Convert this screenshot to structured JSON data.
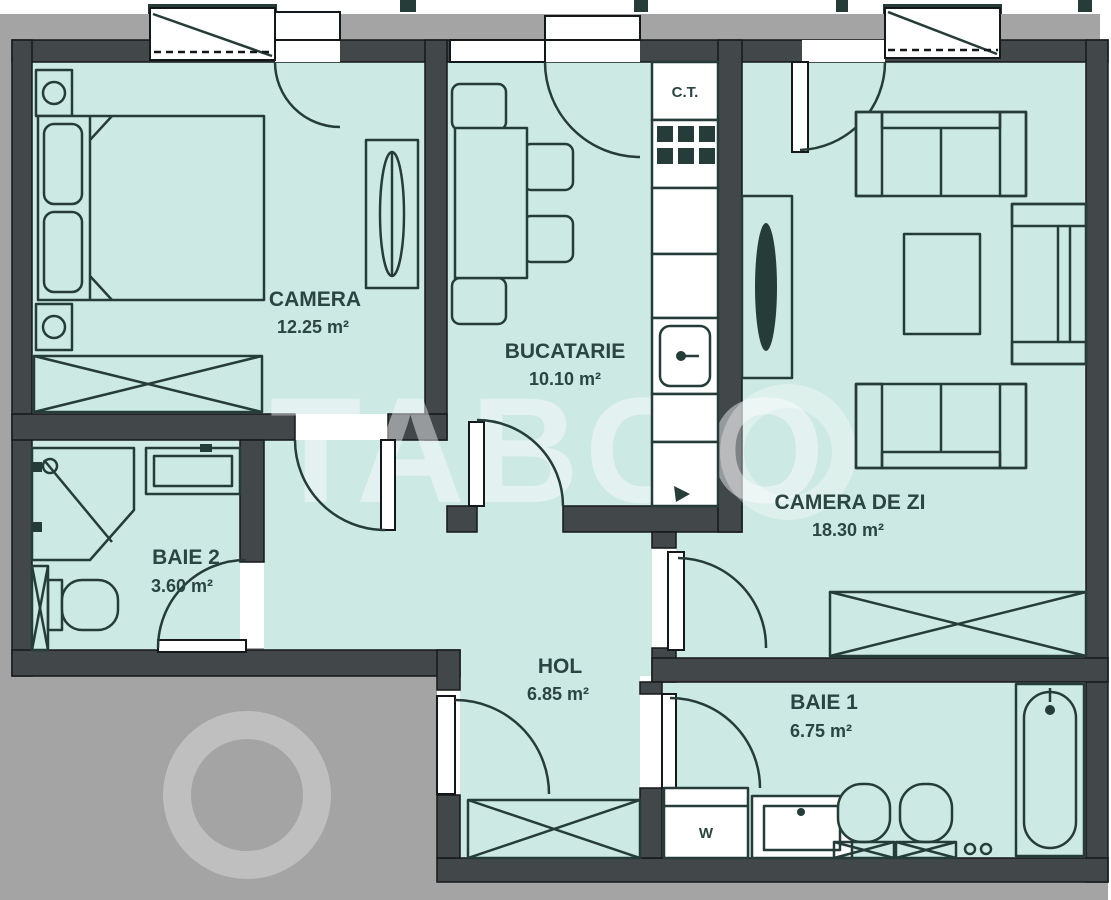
{
  "watermark": {
    "text": "TABOO"
  },
  "colors": {
    "floor": "#cde9e4",
    "wall": "#42474a",
    "outside": "#a3a4a3",
    "line": "#253c39",
    "label": "#2b4542"
  },
  "rooms": {
    "camera": {
      "name": "CAMERA",
      "area": "12.25 m²"
    },
    "bucatarie": {
      "name": "BUCATARIE",
      "area": "10.10 m²"
    },
    "camera_de_zi": {
      "name": "CAMERA DE ZI",
      "area": "18.30 m²"
    },
    "baie2": {
      "name": "BAIE 2",
      "area": "3.60 m²"
    },
    "hol": {
      "name": "HOL",
      "area": "6.85 m²"
    },
    "baie1": {
      "name": "BAIE 1",
      "area": "6.75 m²"
    }
  },
  "fixtures": {
    "boiler_label": "C.T.",
    "washer_label": "W"
  }
}
